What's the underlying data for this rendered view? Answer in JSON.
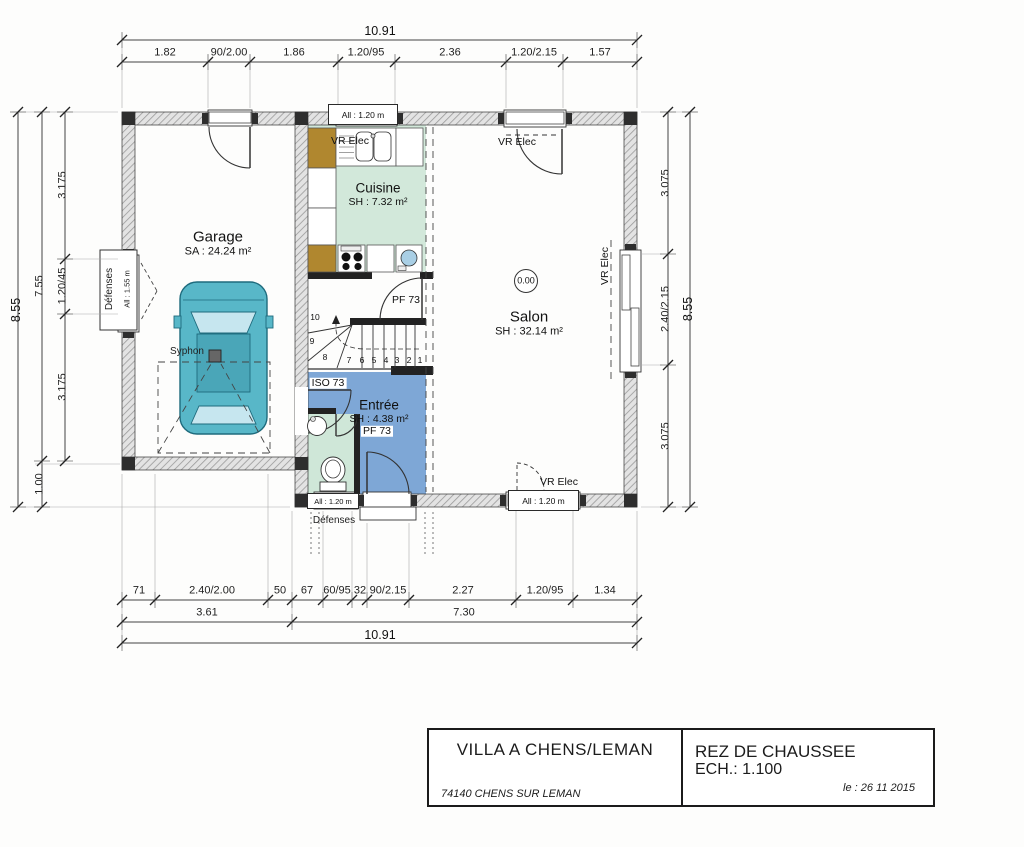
{
  "title_block": {
    "project": "VILLA A CHENS/LEMAN",
    "address": "74140 CHENS SUR LEMAN",
    "sheet": "REZ DE CHAUSSEE",
    "scale": "ECH.: 1.100",
    "date": "le : 26 11 2015"
  },
  "rooms": {
    "garage": {
      "name": "Garage",
      "area": "SA : 24.24 m²"
    },
    "cuisine": {
      "name": "Cuisine",
      "area": "SH : 7.32 m²"
    },
    "salon": {
      "name": "Salon",
      "area": "SH : 32.14 m²"
    },
    "entree": {
      "name": "Entrée",
      "area": "SH : 4.38 m²"
    }
  },
  "labels": {
    "level": "0.00",
    "pf73_hall": "PF 73",
    "pf73_entree": "PF 73",
    "iso73": "ISO 73",
    "vr_elec": "VR Elec",
    "defenses": "Défenses",
    "all_120": "All : 1.20 m",
    "all_155": "All : 1.55 m",
    "syphon": "Syphon"
  },
  "stairs": {
    "steps": [
      "1",
      "2",
      "3",
      "4",
      "5",
      "6",
      "7",
      "8",
      "9",
      "10"
    ]
  },
  "dimensions": {
    "top": {
      "total": "10.91",
      "segments": [
        "1.82",
        "90/2.00",
        "1.86",
        "1.20/95",
        "2.36",
        "1.20/2.15",
        "1.57"
      ]
    },
    "left": {
      "total": "8.55",
      "outer": [
        "7.55",
        "1.00"
      ],
      "inner": [
        "3.175",
        "1.20/45",
        "3.175"
      ]
    },
    "right": {
      "inner": [
        "3.075",
        "2.40/2.15",
        "3.075"
      ],
      "total": "8.55"
    },
    "bottom": {
      "row1": [
        "71",
        "2.40/2.00",
        "50",
        "67",
        "60/95",
        "32",
        "90/2.15",
        "2.27",
        "1.20/95",
        "1.34"
      ],
      "row2": [
        "3.61",
        "7.30"
      ],
      "total": "10.91"
    }
  },
  "colors": {
    "cuisine_floor": "#d2e8da",
    "wc_floor": "#cfe7d8",
    "entree_floor": "#7ea7d6",
    "car_body": "#58b7c8",
    "cabinet_wood": "#b0872f",
    "wall_hatch": "#9a9a9a"
  }
}
